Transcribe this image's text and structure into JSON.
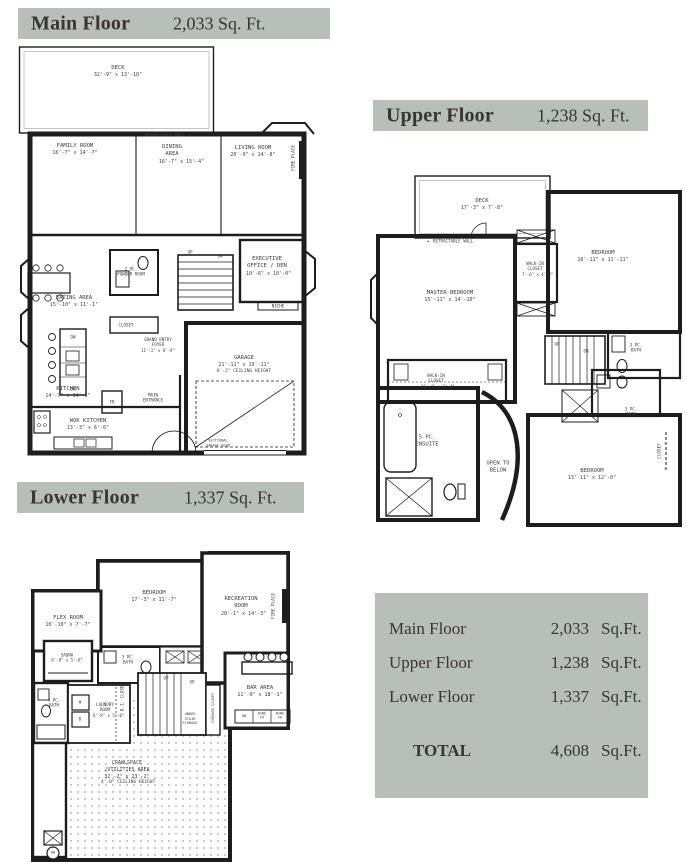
{
  "colors": {
    "panel_bg": "#b8beb8",
    "ink": "#3a3435",
    "plan_line": "#1d1d1d"
  },
  "headers": {
    "main": {
      "title": "Main Floor",
      "area": "2,033 Sq. Ft."
    },
    "upper": {
      "title": "Upper Floor",
      "area": "1,238 Sq. Ft."
    },
    "lower": {
      "title": "Lower Floor",
      "area": "1,337 Sq. Ft."
    }
  },
  "main_floor": {
    "deck": {
      "name": "DECK",
      "dims": "32'-9\" x 13'-10\""
    },
    "retractable_wall": "RETRACTABLE WALL",
    "family_room": {
      "name": "FAMILY ROOM",
      "dims": "16'-7\" x 14'-7\""
    },
    "dining_area": {
      "name": "DINING AREA",
      "dims": "16'-7\" x 15'-4\""
    },
    "living_room": {
      "name": "LIVING ROOM",
      "dims": "20'-9\" x 14'-8\""
    },
    "fireplace": "FIRE PLACE",
    "eating_area": {
      "name": "EATING AREA",
      "dims": "15'-10\" x 11'-1\""
    },
    "powder_room": {
      "name": "2 PC. POWDER ROOM"
    },
    "closet": "CLOSET",
    "grand_entry_foyer": {
      "name": "GRAND ENTRY FOYER",
      "dims": "11'-1\" x 8'-9\""
    },
    "kitchen": {
      "name": "KITCHEN",
      "dims": "14'-7\" x 14'-6\""
    },
    "wok_kitchen": {
      "name": "WOK KITCHEN",
      "dims": "13'-3\" x 6'-6\""
    },
    "fridge": "FR",
    "dw": "DW",
    "main_entrance": "MAIN ENTRANCE",
    "office": {
      "name": "EXECUTIVE OFFICE / DEN",
      "dims": "10'-6\" x 10'-0\""
    },
    "niche": "NICHE",
    "up": "UP",
    "dn": "DN",
    "garage": {
      "name": "GARAGE",
      "dims": "21'-11\" x 19'-11\"",
      "note": "8'-2\" CEILING HEIGHT"
    },
    "garage_door": "SECTIONAL GARAGE DOOR"
  },
  "upper_floor": {
    "deck": {
      "name": "DECK",
      "dims": "17'-3\" x 7'-8\""
    },
    "retractable_wall": "RETRACTABLE WALL",
    "master_bedroom": {
      "name": "MASTER BEDROOM",
      "dims": "15'-11\" x 14'-10\""
    },
    "walkin_closet_1": {
      "name": "WALK-IN CLOSET",
      "dims": "7'-6\" x 4'-4\""
    },
    "bedroom_1": {
      "name": "BEDROOM",
      "dims": "16'-11\" x 11'-11\""
    },
    "bath_1": {
      "name": "3 PC. BATH"
    },
    "walkin_closet_2": {
      "name": "WALK-IN CLOSET",
      "dims": "16'-4\" x 3'-4\""
    },
    "ensuite": {
      "name": "5 PC. ENSUITE"
    },
    "bath_2": {
      "name": "3 PC. BATH"
    },
    "open_to_below": "OPEN TO BELOW",
    "bedroom_2": {
      "name": "BEDROOM",
      "dims": "13'-11\" x 12'-0\""
    },
    "closet": "CLOSET",
    "up": "UP",
    "dn": "DN"
  },
  "lower_floor": {
    "bedroom": {
      "name": "BEDROOM",
      "dims": "17'-3\" x 11'-7\""
    },
    "flex_room": {
      "name": "FLEX ROOM",
      "dims": "10'-10\" x 7'-7\""
    },
    "recreation_room": {
      "name": "RECREATION ROOM",
      "dims": "20'-1\" x 14'-3\""
    },
    "fireplace": "FIRE PLACE",
    "sauna": {
      "name": "SAUNA",
      "dims": "6'-0\" x 5'-6\""
    },
    "bath_3pc": {
      "name": "3 PC. BATH"
    },
    "bath_4pc": {
      "name": "4 PC. BATH"
    },
    "laundry": {
      "name": "LAUNDRY ROOM",
      "dims": "6'-8\" x 5'-0\""
    },
    "washer": "W",
    "dryer": "D",
    "bi_closet": "B.I. CLOSET",
    "up": "UP",
    "under_stair_storage": "UNDER STAIR STORAGE",
    "storage_closet": {
      "name": "STORAGE CLOSET",
      "dims": "5'-10\" x 3'-4\""
    },
    "bar_area": {
      "name": "BAR AREA",
      "dims": "11'-0\" x 18'-1\""
    },
    "dw": "DW",
    "wine_fr": "WINE FR",
    "crawlspace": {
      "name": "CRAWLSPACE /UTILITIES AREA",
      "dims": "32'-2\" x 23'-2\"",
      "note": "4'-0\" CEILING HEIGHT"
    },
    "hw": "HW"
  },
  "summary": {
    "rows": [
      {
        "label": "Main Floor",
        "value": "2,033",
        "unit": "Sq.Ft."
      },
      {
        "label": "Upper Floor",
        "value": "1,238",
        "unit": "Sq.Ft."
      },
      {
        "label": "Lower Floor",
        "value": "1,337",
        "unit": "Sq.Ft."
      }
    ],
    "total": {
      "label": "TOTAL",
      "value": "4,608",
      "unit": "Sq.Ft."
    }
  }
}
